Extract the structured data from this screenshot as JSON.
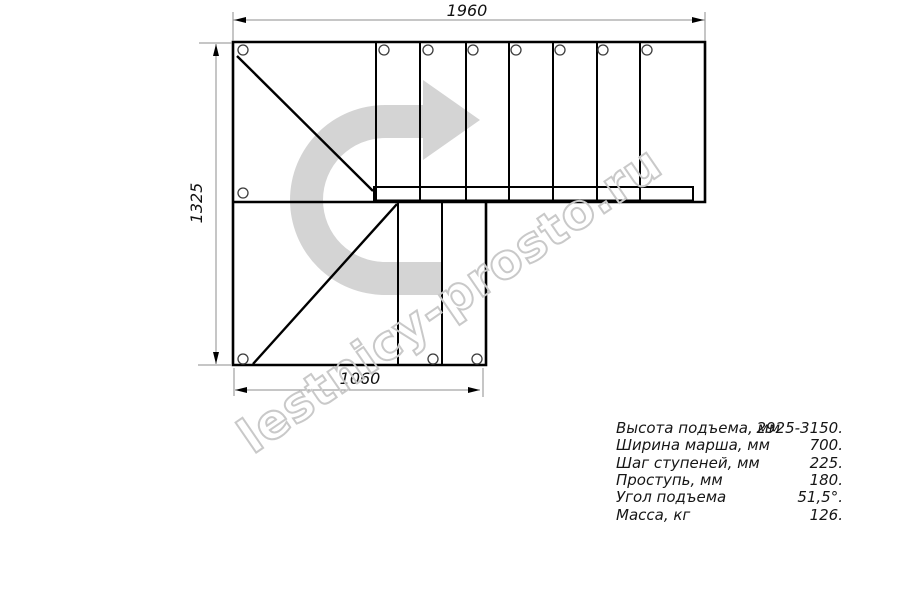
{
  "drawing": {
    "title": "L-shaped staircase plan view",
    "dim_top": "1960",
    "dim_left": "1325",
    "dim_bottom": "1060"
  },
  "specs": {
    "rows": [
      {
        "label": "Высота подъема, мм",
        "value": "2925-3150."
      },
      {
        "label": "Ширина марша, мм",
        "value": "700."
      },
      {
        "label": "Шаг ступеней, мм",
        "value": "225."
      },
      {
        "label": "Проступь, мм",
        "value": "180."
      },
      {
        "label": "Угол подъема",
        "value": "51,5°."
      },
      {
        "label": "Масса, кг",
        "value": "126."
      }
    ]
  },
  "watermark": {
    "text": "lestnicy-prosto.ru"
  },
  "colors": {
    "line": "#000000",
    "dimension_line": "#8c8c8c",
    "arrow_fill": "#d4d4d4",
    "watermark_stroke": "#c9c9c9",
    "text": "#161616",
    "background": "#ffffff"
  }
}
